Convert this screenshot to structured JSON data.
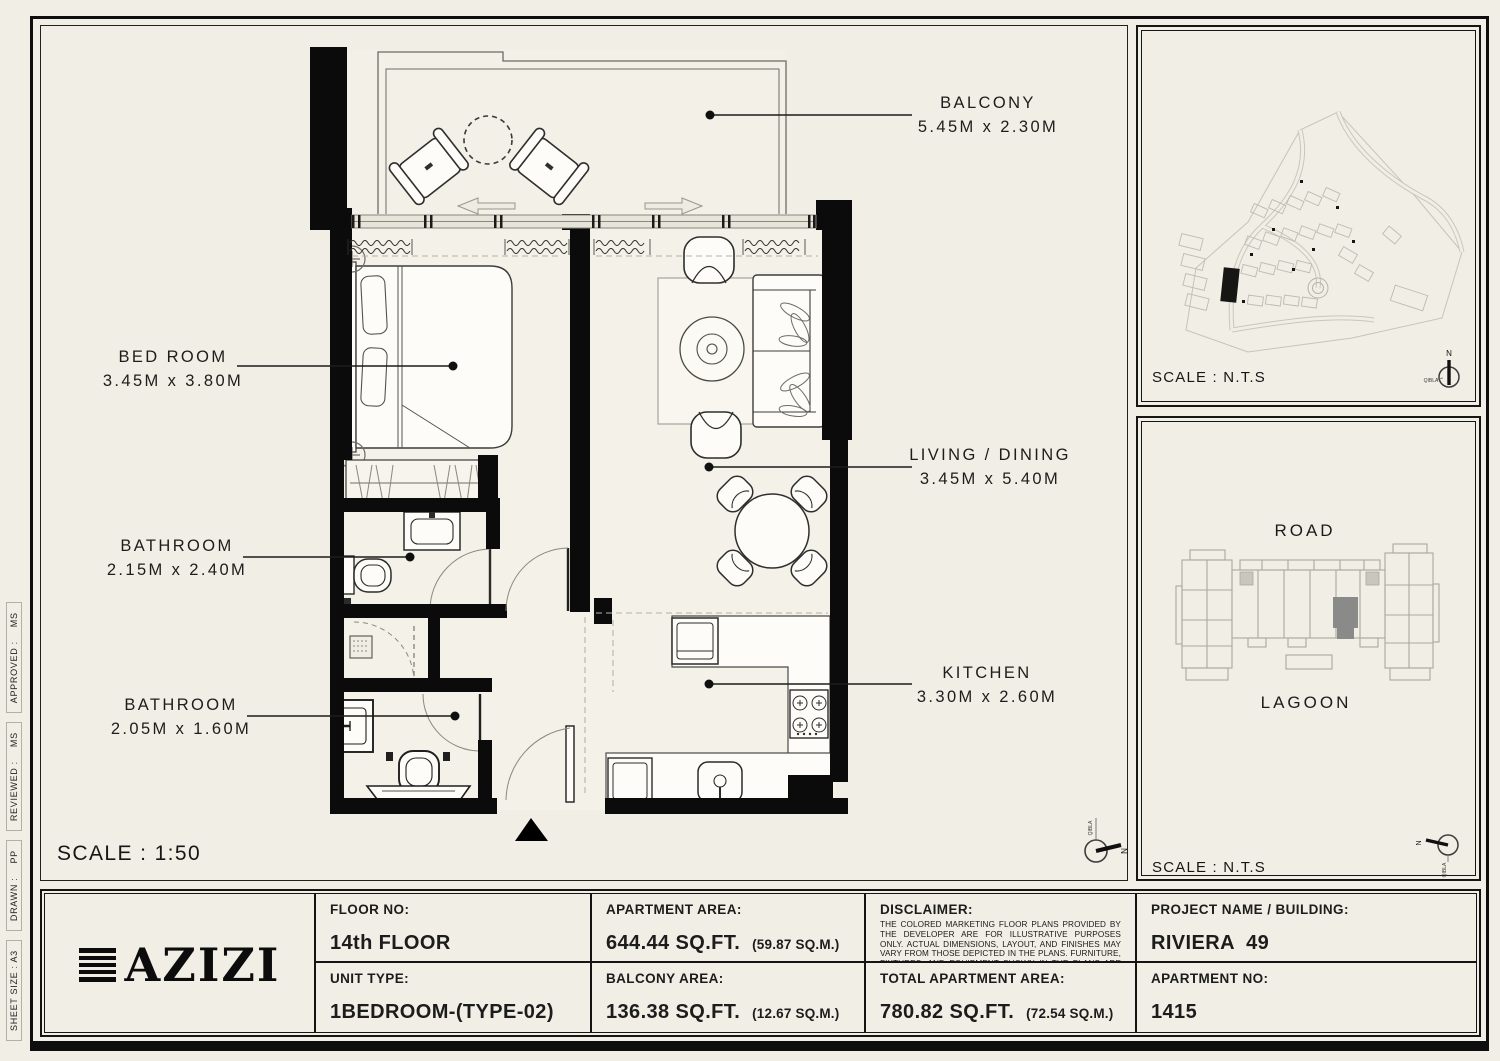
{
  "colors": {
    "paper": "#f1eee5",
    "wall": "#0b0b0b",
    "highlight_unit": "#8a8a88",
    "ink": "#161616"
  },
  "side_strip": {
    "sheet_size": "SHEET SIZE : A3",
    "drawn_label": "DRAWN :",
    "drawn_value": "PP",
    "reviewed_label": "REVIEWED :",
    "reviewed_value": "MS",
    "approved_label": "APPROVED :",
    "approved_value": "MS"
  },
  "floor_plan": {
    "scale": "SCALE : 1:50",
    "rooms": [
      {
        "name": "BALCONY",
        "dims": "5.45M x 2.30M"
      },
      {
        "name": "BED ROOM",
        "dims": "3.45M x 3.80M"
      },
      {
        "name": "LIVING / DINING",
        "dims": "3.45M x 5.40M"
      },
      {
        "name": "BATHROOM",
        "dims": "2.15M x 2.40M"
      },
      {
        "name": "BATHROOM",
        "dims": "2.05M x 1.60M"
      },
      {
        "name": "KITCHEN",
        "dims": "3.30M x 2.60M"
      }
    ],
    "compass": {
      "north": "N",
      "qibla": "QIBLA"
    }
  },
  "site_plan": {
    "scale": "SCALE : N.T.S",
    "compass": {
      "north": "N",
      "qibla": "QIBLA"
    }
  },
  "key_plan": {
    "road": "ROAD",
    "lagoon": "LAGOON",
    "scale": "SCALE : N.T.S",
    "compass": {
      "north": "N",
      "qibla": "QIBLA"
    }
  },
  "title_block": {
    "logo_text": "AZIZI",
    "cells": {
      "floor": {
        "label": "FLOOR NO:",
        "value": "14th FLOOR"
      },
      "unit_type": {
        "label": "UNIT TYPE:",
        "value": "1BEDROOM-(TYPE-02)"
      },
      "apartment_area": {
        "label": "APARTMENT AREA:",
        "value": "644.44 SQ.FT.",
        "metric": "(59.87 SQ.M.)"
      },
      "balcony_area": {
        "label": "BALCONY AREA:",
        "value": "136.38 SQ.FT.",
        "metric": "(12.67 SQ.M.)"
      },
      "disclaimer": {
        "label": "DISCLAIMER:",
        "text": "THE COLORED MARKETING FLOOR PLANS PROVIDED BY THE DEVELOPER ARE FOR ILLUSTRATIVE PURPOSES ONLY. ACTUAL DIMENSIONS, LAYOUT, AND FINISHES MAY VARY FROM THOSE DEPICTED IN THE PLANS. FURNITURE, FIXTURES, AND EQUIPMENT SHOWN IN THE PLANS ARE FOR DECORATIVE PURPOSES ONLY AND ARE NOT INCLUDED IN THE PURCHASE OR LEASE OF THE PROPERTY. THE DEVELOPER RESERVES THE RIGHT TO MAKE MODIFICATIONS, REVISIONS, AND CHANGES TO THE FLOOR PLANS, SPECIFICATIONS, AND FEATURES WITHOUT PRIOR NOTICE."
      },
      "total_area": {
        "label": "TOTAL APARTMENT AREA:",
        "value": "780.82 SQ.FT.",
        "metric": "(72.54 SQ.M.)"
      },
      "project": {
        "label": "PROJECT NAME / BUILDING:",
        "value": "RIVIERA  49"
      },
      "apartment_no": {
        "label": "APARTMENT NO:",
        "value": "1415"
      }
    }
  }
}
